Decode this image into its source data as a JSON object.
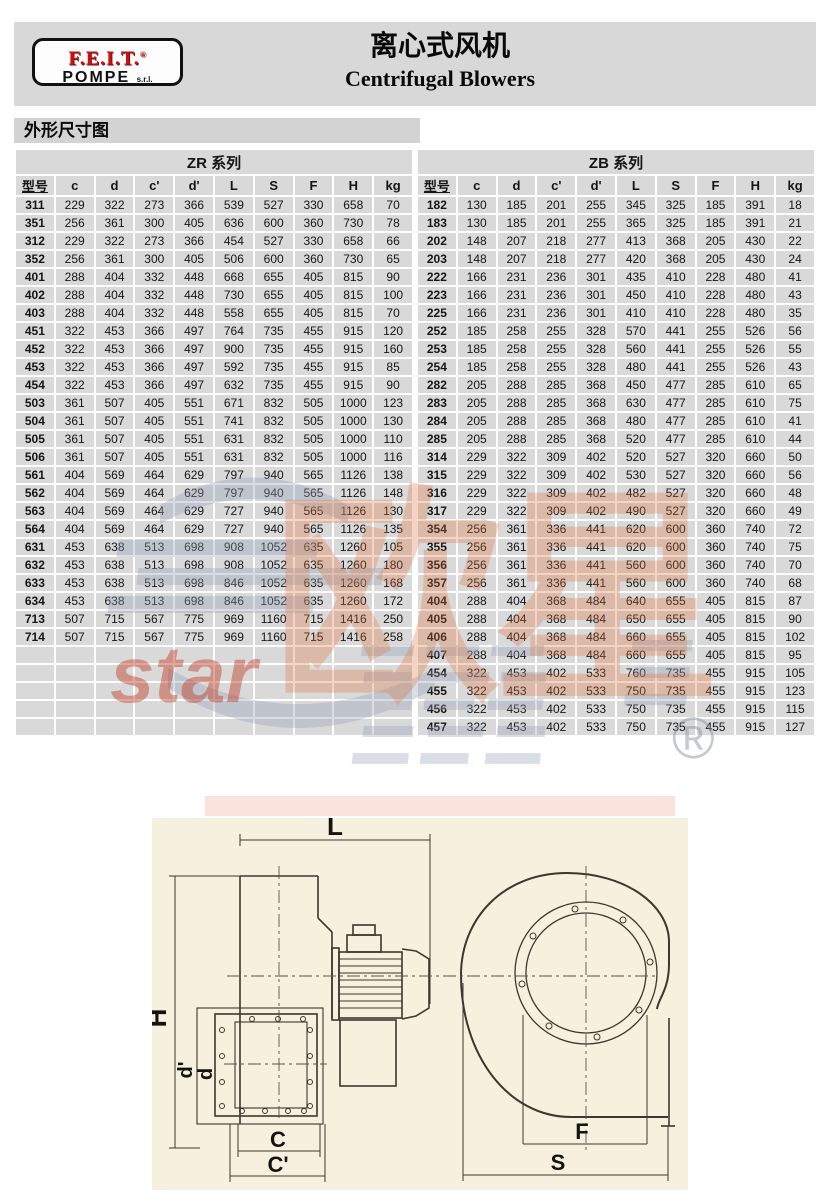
{
  "header": {
    "logo_line1": "F.E.I.T.",
    "logo_reg": "®",
    "logo_line2": "POMPE",
    "logo_suffix": "s.r.l.",
    "title_zh": "离心式风机",
    "title_en": "Centrifugal Blowers"
  },
  "section": {
    "label": "外形尺寸图"
  },
  "tables": {
    "columns": [
      "型号",
      "c",
      "d",
      "c'",
      "d'",
      "L",
      "S",
      "F",
      "H",
      "kg"
    ],
    "zr": {
      "title": "ZR 系列",
      "empty_rows": 5,
      "rows": [
        [
          "311",
          229,
          322,
          273,
          366,
          539,
          527,
          330,
          658,
          70
        ],
        [
          "351",
          256,
          361,
          300,
          405,
          636,
          600,
          360,
          730,
          78
        ],
        [
          "312",
          229,
          322,
          273,
          366,
          454,
          527,
          330,
          658,
          66
        ],
        [
          "352",
          256,
          361,
          300,
          405,
          506,
          600,
          360,
          730,
          65
        ],
        [
          "401",
          288,
          404,
          332,
          448,
          668,
          655,
          405,
          815,
          90
        ],
        [
          "402",
          288,
          404,
          332,
          448,
          730,
          655,
          405,
          815,
          100
        ],
        [
          "403",
          288,
          404,
          332,
          448,
          558,
          655,
          405,
          815,
          70
        ],
        [
          "451",
          322,
          453,
          366,
          497,
          764,
          735,
          455,
          915,
          120
        ],
        [
          "452",
          322,
          453,
          366,
          497,
          900,
          735,
          455,
          915,
          160
        ],
        [
          "453",
          322,
          453,
          366,
          497,
          592,
          735,
          455,
          915,
          85
        ],
        [
          "454",
          322,
          453,
          366,
          497,
          632,
          735,
          455,
          915,
          90
        ],
        [
          "503",
          361,
          507,
          405,
          551,
          671,
          832,
          505,
          1000,
          123
        ],
        [
          "504",
          361,
          507,
          405,
          551,
          741,
          832,
          505,
          1000,
          130
        ],
        [
          "505",
          361,
          507,
          405,
          551,
          631,
          832,
          505,
          1000,
          110
        ],
        [
          "506",
          361,
          507,
          405,
          551,
          631,
          832,
          505,
          1000,
          116
        ],
        [
          "561",
          404,
          569,
          464,
          629,
          797,
          940,
          565,
          1126,
          138
        ],
        [
          "562",
          404,
          569,
          464,
          629,
          797,
          940,
          565,
          1126,
          148
        ],
        [
          "563",
          404,
          569,
          464,
          629,
          727,
          940,
          565,
          1126,
          130
        ],
        [
          "564",
          404,
          569,
          464,
          629,
          727,
          940,
          565,
          1126,
          135
        ],
        [
          "631",
          453,
          638,
          513,
          698,
          908,
          1052,
          635,
          1260,
          105
        ],
        [
          "632",
          453,
          638,
          513,
          698,
          908,
          1052,
          635,
          1260,
          180
        ],
        [
          "633",
          453,
          638,
          513,
          698,
          846,
          1052,
          635,
          1260,
          168
        ],
        [
          "634",
          453,
          638,
          513,
          698,
          846,
          1052,
          635,
          1260,
          172
        ],
        [
          "713",
          507,
          715,
          567,
          775,
          969,
          1160,
          715,
          1416,
          250
        ],
        [
          "714",
          507,
          715,
          567,
          775,
          969,
          1160,
          715,
          1416,
          258
        ]
      ]
    },
    "zb": {
      "title": "ZB 系列",
      "empty_rows": 0,
      "rows": [
        [
          "182",
          130,
          185,
          201,
          255,
          345,
          325,
          185,
          391,
          18
        ],
        [
          "183",
          130,
          185,
          201,
          255,
          365,
          325,
          185,
          391,
          21
        ],
        [
          "202",
          148,
          207,
          218,
          277,
          413,
          368,
          205,
          430,
          22
        ],
        [
          "203",
          148,
          207,
          218,
          277,
          420,
          368,
          205,
          430,
          24
        ],
        [
          "222",
          166,
          231,
          236,
          301,
          435,
          410,
          228,
          480,
          41
        ],
        [
          "223",
          166,
          231,
          236,
          301,
          450,
          410,
          228,
          480,
          43
        ],
        [
          "225",
          166,
          231,
          236,
          301,
          410,
          410,
          228,
          480,
          35
        ],
        [
          "252",
          185,
          258,
          255,
          328,
          570,
          441,
          255,
          526,
          56
        ],
        [
          "253",
          185,
          258,
          255,
          328,
          560,
          441,
          255,
          526,
          55
        ],
        [
          "254",
          185,
          258,
          255,
          328,
          480,
          441,
          255,
          526,
          43
        ],
        [
          "282",
          205,
          288,
          285,
          368,
          450,
          477,
          285,
          610,
          65
        ],
        [
          "283",
          205,
          288,
          285,
          368,
          630,
          477,
          285,
          610,
          75
        ],
        [
          "284",
          205,
          288,
          285,
          368,
          480,
          477,
          285,
          610,
          41
        ],
        [
          "285",
          205,
          288,
          285,
          368,
          520,
          477,
          285,
          610,
          44
        ],
        [
          "314",
          229,
          322,
          309,
          402,
          520,
          527,
          320,
          660,
          50
        ],
        [
          "315",
          229,
          322,
          309,
          402,
          530,
          527,
          320,
          660,
          56
        ],
        [
          "316",
          229,
          322,
          309,
          402,
          482,
          527,
          320,
          660,
          48
        ],
        [
          "317",
          229,
          322,
          309,
          402,
          490,
          527,
          320,
          660,
          49
        ],
        [
          "354",
          256,
          361,
          336,
          441,
          620,
          600,
          360,
          740,
          72
        ],
        [
          "355",
          256,
          361,
          336,
          441,
          620,
          600,
          360,
          740,
          75
        ],
        [
          "356",
          256,
          361,
          336,
          441,
          560,
          600,
          360,
          740,
          70
        ],
        [
          "357",
          256,
          361,
          336,
          441,
          560,
          600,
          360,
          740,
          68
        ],
        [
          "404",
          288,
          404,
          368,
          484,
          640,
          655,
          405,
          815,
          87
        ],
        [
          "405",
          288,
          404,
          368,
          484,
          650,
          655,
          405,
          815,
          90
        ],
        [
          "406",
          288,
          404,
          368,
          484,
          660,
          655,
          405,
          815,
          102
        ],
        [
          "407",
          288,
          404,
          368,
          484,
          660,
          655,
          405,
          815,
          95
        ],
        [
          "454",
          322,
          453,
          402,
          533,
          760,
          735,
          455,
          915,
          105
        ],
        [
          "455",
          322,
          453,
          402,
          533,
          750,
          735,
          455,
          915,
          123
        ],
        [
          "456",
          322,
          453,
          402,
          533,
          750,
          735,
          455,
          915,
          115
        ],
        [
          "457",
          322,
          453,
          402,
          533,
          750,
          735,
          455,
          915,
          127
        ]
      ]
    }
  },
  "watermark": {
    "text_cn": "欧星",
    "text_en": "star",
    "reg": "®"
  },
  "diagram": {
    "labels": {
      "L": "L",
      "H": "H",
      "d_prime": "d'",
      "d": "d",
      "C": "C",
      "C_prime": "C'",
      "F": "F",
      "S": "S"
    }
  }
}
